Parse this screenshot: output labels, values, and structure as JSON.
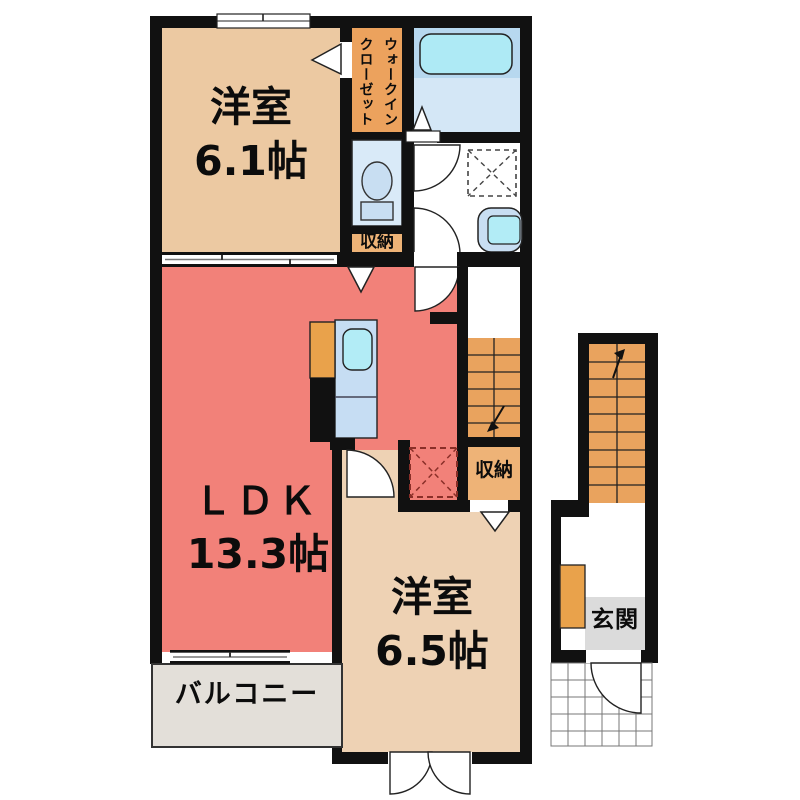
{
  "type": "floor-plan",
  "labels": {
    "room61_name": "洋室",
    "room61_size": "6.1帖",
    "wic_col1": "ウォークイン",
    "wic_col2": "クローゼット",
    "storage_top": "収納",
    "storage_right": "収納",
    "ldk_name": "ＬＤＫ",
    "ldk_size": "13.3帖",
    "room65_name": "洋室",
    "room65_size": "6.5帖",
    "balcony": "バルコニー",
    "genkan": "玄関"
  },
  "colors": {
    "wall": "#111111",
    "room61": "#ecc9a2",
    "room65": "#eed2b4",
    "ldk": "#f28179",
    "wic": "#eca25d",
    "stairs": "#e9a35e",
    "storage": "#eeb377",
    "toilet_room": "#d9eaf8",
    "bath_upper": "#b7d8ef",
    "bath_lower": "#d4e7f6",
    "bathtub": "#aeeaf5",
    "counter": "#c6ddf3",
    "sink": "#b2ecf6",
    "fridge": "#e9a24b",
    "fixture": "#c8def2",
    "balcony_floor": "#e3dfd9",
    "genkan_floor": "#dbdbdb",
    "dashed_red": "#8a2f28"
  }
}
